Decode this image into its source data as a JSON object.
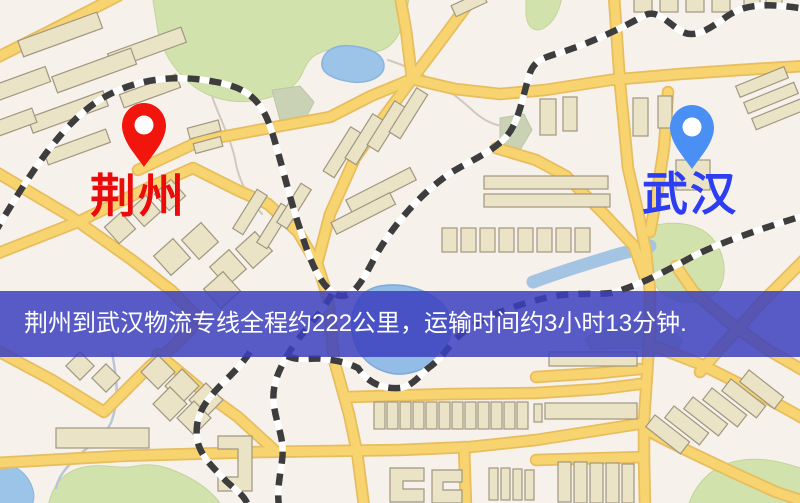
{
  "banner": {
    "text": "荆州到武汉物流专线全程约222公里，运输时间约3小时13分钟.",
    "background": "#3c40be",
    "text_color": "#ffffff"
  },
  "route_info": {
    "origin": "荆州",
    "destination": "武汉",
    "distance_text": "约222公里",
    "duration_text": "约3小时13分钟"
  },
  "map": {
    "city_labels": [
      {
        "name": "荆州",
        "color": "#ea0b0b"
      },
      {
        "name": "武汉",
        "color": "#2d3ef2"
      }
    ],
    "markers": [
      {
        "city": "荆州",
        "color": "#f2150d"
      },
      {
        "city": "武汉",
        "color": "#4a90f4"
      }
    ],
    "palette": {
      "background": "#f7f1ec",
      "road_fill": "#f8d470",
      "road_casing": "#e7bd5e",
      "building_fill": "#ebe3c6",
      "building_stroke": "#a09780",
      "park_green": "#d2e2ad",
      "muted_green": "#c9d2b4",
      "water_blue": "#9cc3e8",
      "railway_dash": "#3d3d3d"
    }
  }
}
